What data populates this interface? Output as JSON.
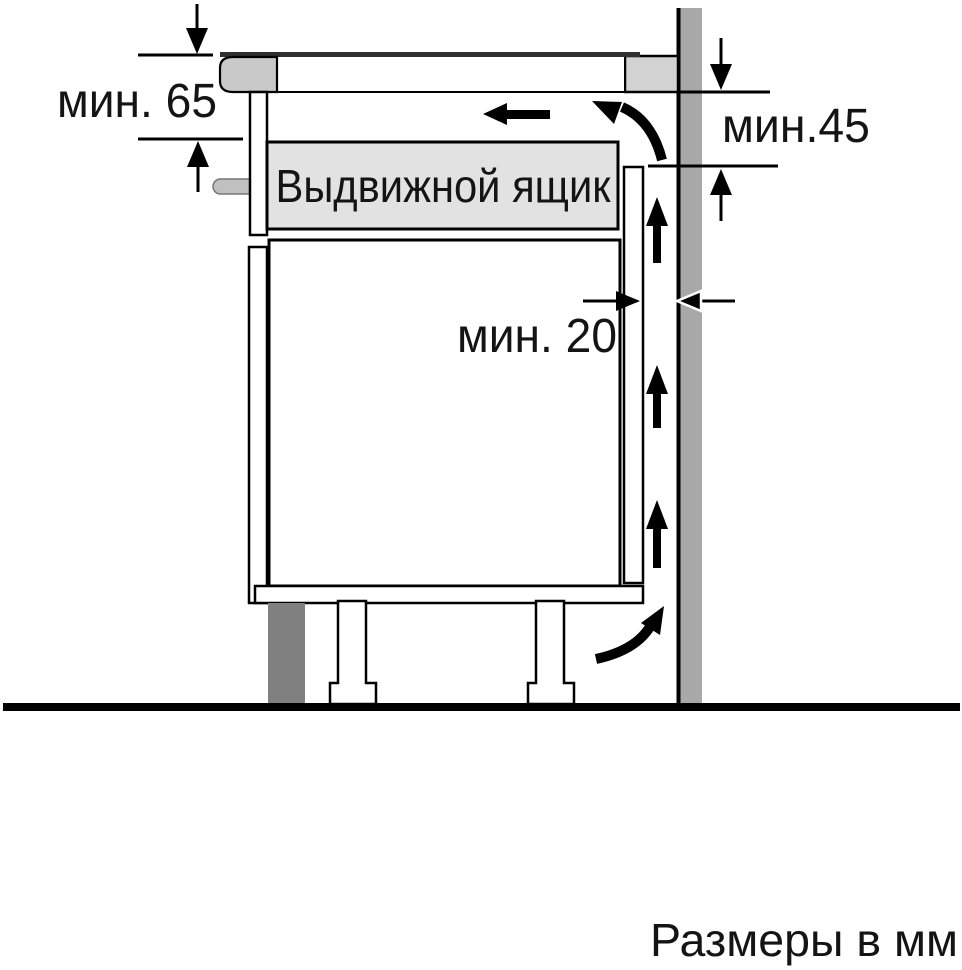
{
  "diagram": {
    "labels": {
      "min_top_clearance": "мин. 65",
      "min_side_clearance": "мин.45",
      "min_back_gap": "мин. 20",
      "drawer": "Выдвижной ящик",
      "units_note": "Размеры в мм"
    },
    "colors": {
      "wall": "#a8a8a8",
      "plinth": "#808080",
      "drawer_box": "#e2e2e2",
      "countertop": "#d2d2d2",
      "hob_body": "#c9c9c9",
      "handle": "#c0c0c0",
      "glass": "#2f2f2f",
      "line": "#000000"
    }
  }
}
